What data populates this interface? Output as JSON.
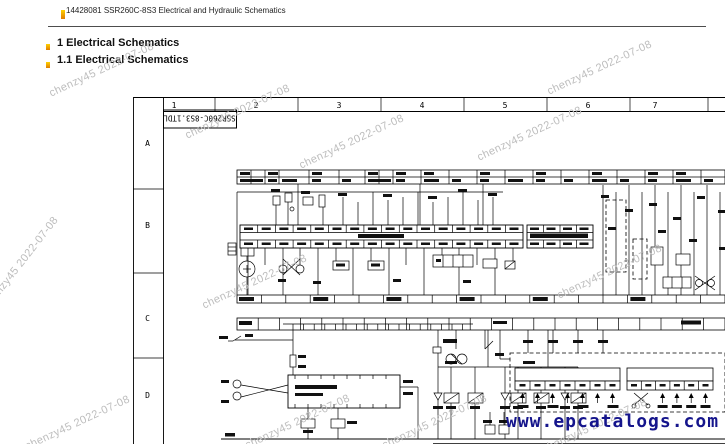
{
  "page": {
    "header": {
      "title": "14428081 SSR260C-8S3 Electrical and Hydraulic Schematics"
    },
    "headings": {
      "section": "1 Electrical Schematics",
      "subsection": "1.1 Electrical Schematics"
    },
    "watermark": {
      "text": "chenzy45 2022-07-08",
      "color": "#bdbdbd"
    },
    "site_watermark": {
      "text": "www.epcatalogs.com",
      "color": "#15158c"
    },
    "accent_marker": {
      "top_color": "#ffd200",
      "bottom_color": "#e07c00"
    }
  },
  "schematic": {
    "title_block": "SSR260C-8S3.1TDL",
    "grid_columns": [
      "1",
      "2",
      "3",
      "4",
      "5",
      "6",
      "7"
    ],
    "grid_rows": [
      "A",
      "B",
      "C",
      "D"
    ],
    "blocks": {
      "instrument_terminal_a": "Instrument-terminal A",
      "instrument_terminal_b": "Instrument-terminal B"
    }
  }
}
